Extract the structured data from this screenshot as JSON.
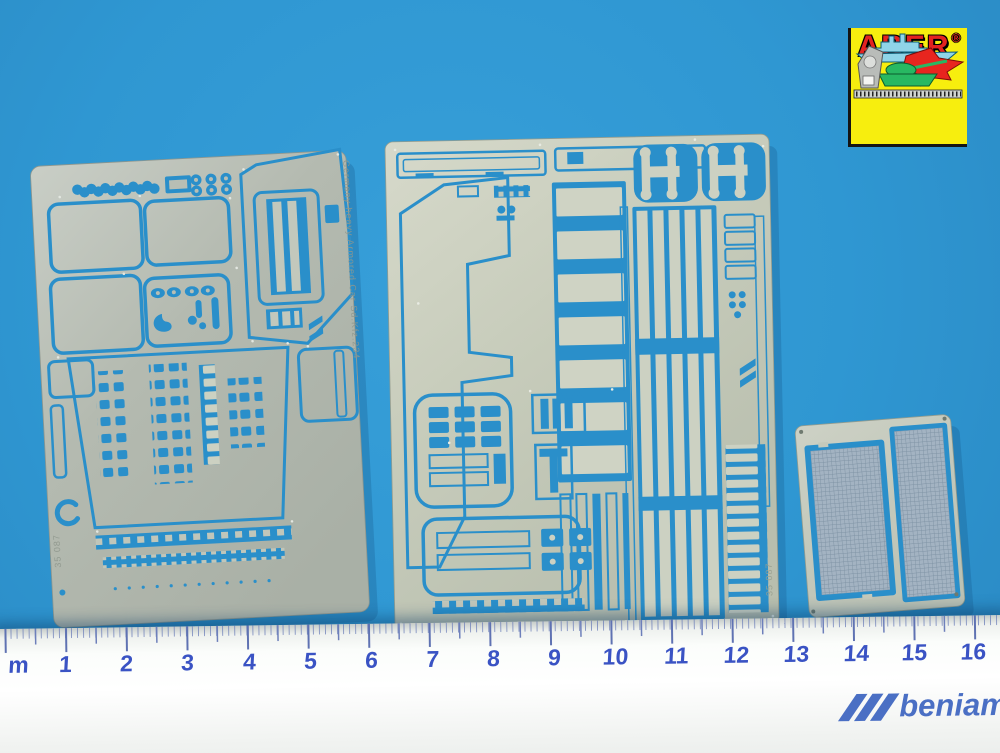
{
  "colors": {
    "background": "#2f97d2",
    "cutout_blue": "#2a8fca",
    "metal": "#bec4b8",
    "mesh": "#a3b3c2",
    "ruler_numbers": "#3a53c4",
    "beniamin_blue": "#4a6fc4",
    "aber_red": "#e42320",
    "aber_yellow": "#f7ee0e"
  },
  "aber_logo": {
    "brand": "ABER",
    "registered": "®",
    "icons": [
      "battleship-icon",
      "fighter-jet-icon",
      "tank-icon",
      "caliper-icon",
      "ruler-icon"
    ]
  },
  "ruler": {
    "labels": [
      "m",
      "1",
      "2",
      "3",
      "4",
      "5",
      "6",
      "7",
      "8",
      "9",
      "10",
      "11",
      "12",
      "13",
      "14",
      "15",
      "16"
    ]
  },
  "beniamin_logo": {
    "text": "beniamin"
  },
  "frets": {
    "left": {
      "etched_text": "Germany heavy Armored Car Sd.Kfz.234",
      "etched_code": "35 087"
    },
    "middle": {
      "etched_code": "35 087"
    },
    "right": {}
  }
}
